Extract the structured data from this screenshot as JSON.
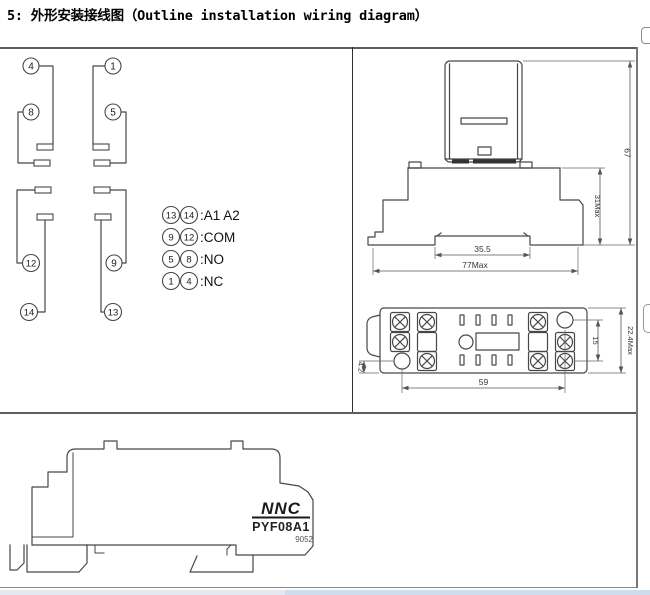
{
  "header": {
    "title": "5: 外形安装接线图（Outline installation wiring diagram）"
  },
  "colors": {
    "drawing_line": "#474747",
    "table_border": "#5d5d5d",
    "scroll_band_left": "#e4e9f1",
    "scroll_band_right": "#cfdbee"
  },
  "wiring_cell": {
    "pins": {
      "p4": "4",
      "p1": "1",
      "p8": "8",
      "p5": "5",
      "p12": "12",
      "p9": "9",
      "p14": "14",
      "p13": "13"
    },
    "legend": [
      {
        "a": "13",
        "b": "14",
        "label": ":A1 A2"
      },
      {
        "a": "9",
        "b": "12",
        "label": ":COM"
      },
      {
        "a": "5",
        "b": "8",
        "label": ":NO"
      },
      {
        "a": "1",
        "b": "4",
        "label": ":NC"
      }
    ]
  },
  "side_view": {
    "dim_width_inner": "35.5",
    "dim_width_overall": "77Max",
    "dim_height_overall": "67",
    "dim_height_socket": "31Max"
  },
  "bottom_view": {
    "dim_hole_offset": "4.2",
    "dim_hole_span": "59",
    "dim_row_span": "15",
    "dim_depth": "22.4Max"
  },
  "profile_view": {
    "brand": "NNC",
    "model": "PYF08A1",
    "code": "9052"
  }
}
